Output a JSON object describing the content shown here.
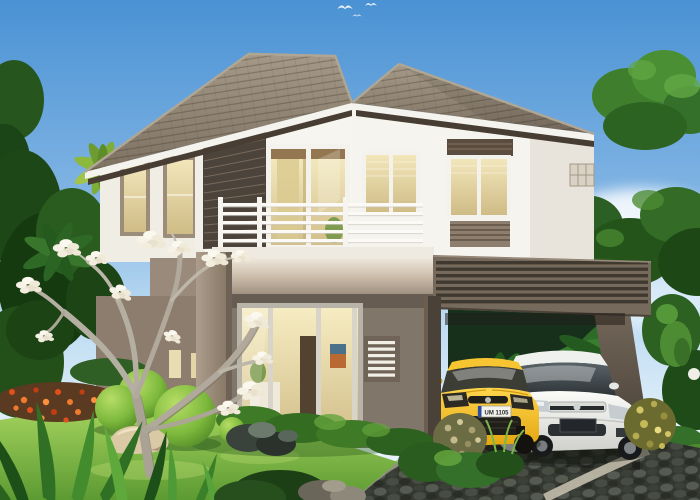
{
  "scene": {
    "description": "3D architectural rendering of a modern two-storey tropical house with balcony, slatted carport, two parked cars and landscaped garden",
    "sky": {
      "top_color": "#4a92d4",
      "horizon_color": "#eef6fc",
      "bird_count": 3
    },
    "house": {
      "storeys": 2,
      "wall_color": "#f6f4ee",
      "accent_band_color": "#a5968a",
      "dark_siding_color": "#4c443b",
      "roof_tile_color": "#8d8274",
      "window_glow_color": "#e9dcab",
      "balcony_railing_color": "#fbfaf7",
      "railing_bar_count": 5
    },
    "carport": {
      "frame_color": "#756a5c",
      "slat_count": 7
    },
    "cars": {
      "yellow_hatchback": {
        "body_color": "#f2b91c",
        "plate": "UM 1105",
        "plate_color": "#f2f2ea",
        "emblem": "seat-badge"
      },
      "white_sedan": {
        "body_color": "#f2f2ef",
        "plate": "",
        "plate_color": "#23272c",
        "emblem": "honda-badge"
      }
    },
    "garden": {
      "lawn_color": "#7ab845",
      "topiary_sphere_count": 3,
      "flower_bed_colors": [
        "#e25018",
        "#f07a2e"
      ],
      "flowering_tree": "white plumeria",
      "driveway_surface_color": "#343830",
      "path_edge_color": "#c2bcab",
      "rock_color": "#d9c9a5"
    }
  }
}
